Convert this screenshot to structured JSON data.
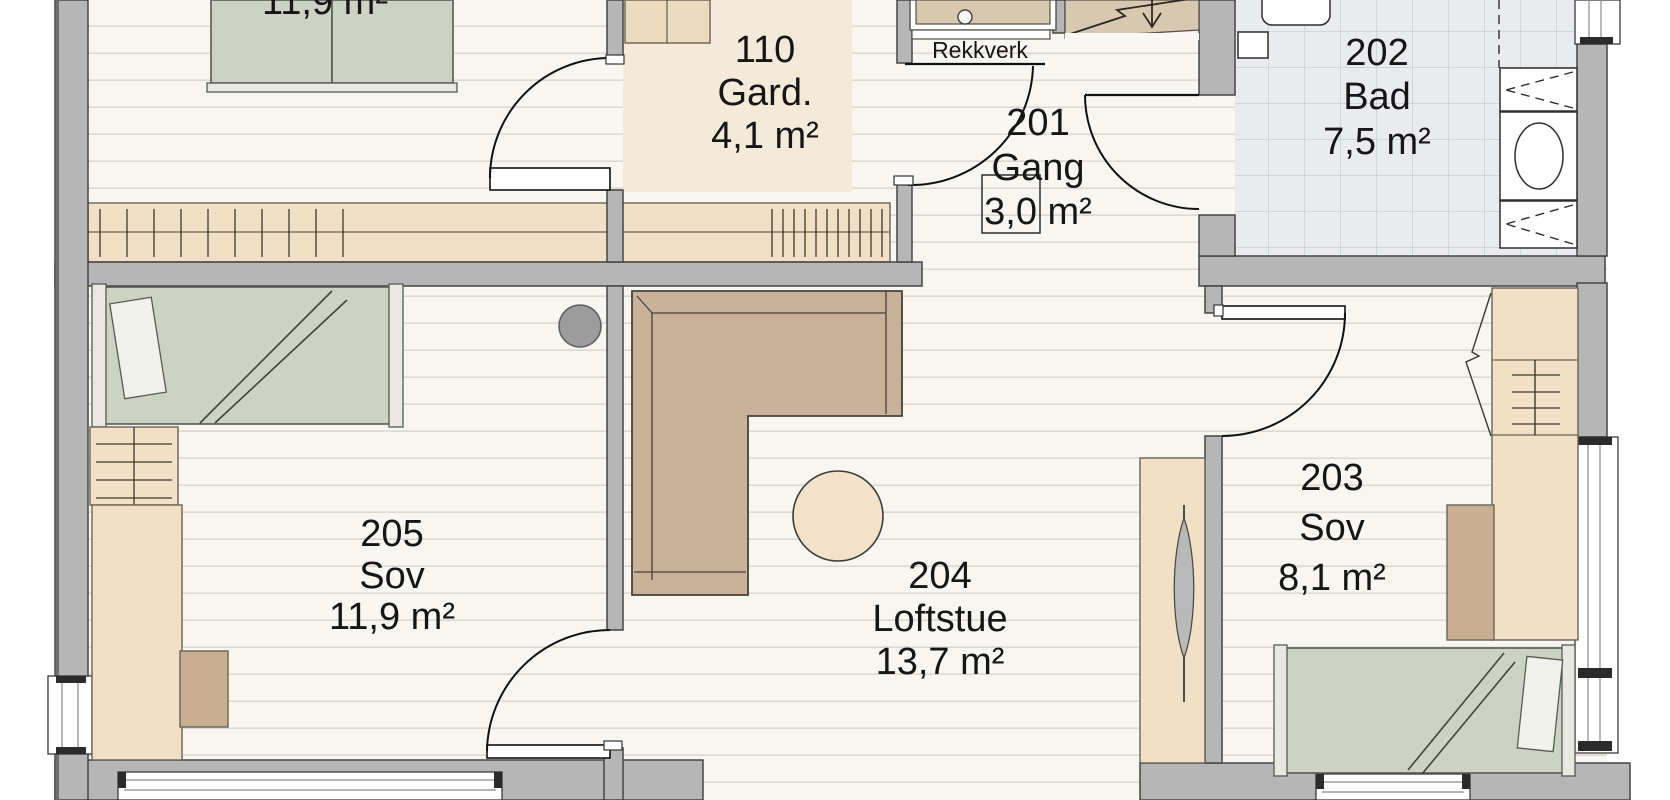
{
  "plan_title": "Loft floor plan",
  "labels": {
    "railing": "Rekkverk"
  },
  "rooms": [
    {
      "number": "",
      "name": "",
      "area": "11,9 m²"
    },
    {
      "number": "110",
      "name": "Gard.",
      "area": "4,1 m²"
    },
    {
      "number": "201",
      "name": "Gang",
      "area": "3,0 m²"
    },
    {
      "number": "202",
      "name": "Bad",
      "area": "7,5 m²"
    },
    {
      "number": "203",
      "name": "Sov",
      "area": "8,1 m²"
    },
    {
      "number": "204",
      "name": "Loftstue",
      "area": "13,7 m²"
    },
    {
      "number": "205",
      "name": "Sov",
      "area": "11,9 m²"
    }
  ],
  "colors": {
    "wall_gray": "#b6b6b6",
    "floor_plank": "#f8f6f1",
    "plank_line": "#dcd9d1",
    "tile_floor": "#e9ebee",
    "tile_line": "#c9cdd5",
    "closet_tan": "#f2e0c6",
    "gard_highlight": "#f3ead9",
    "sofa_brown": "#c9b299",
    "bed_green": "#cdd2c5",
    "desk_brown": "#c9ae92",
    "text": "#161616"
  }
}
